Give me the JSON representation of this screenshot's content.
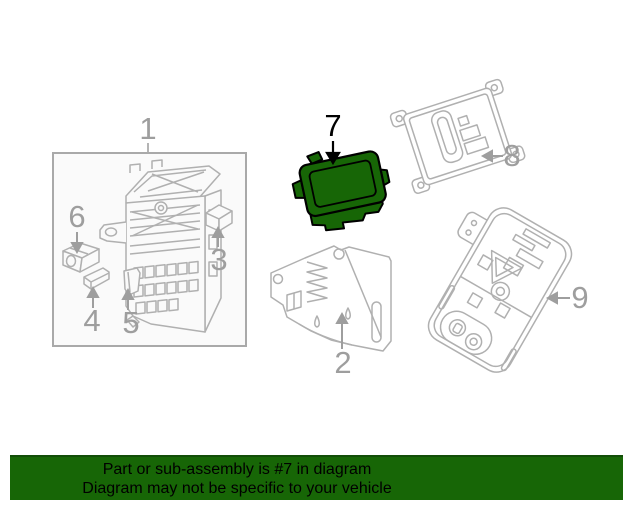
{
  "diagram": {
    "labels": [
      "1",
      "2",
      "3",
      "4",
      "5",
      "6",
      "7",
      "8",
      "9"
    ],
    "highlighted_part_label": "7",
    "colors": {
      "highlight_green": "#176606",
      "highlight_outline": "#000000",
      "line_gray": "#b0b0b0",
      "label_gray": "#9e9e9e",
      "box_border_gray": "#a9a9a9",
      "box_fill": "#fafafa"
    }
  },
  "banner": {
    "line1": "Part or sub-assembly is #7 in diagram",
    "line2": "Diagram may not be specific to your vehicle",
    "background": "#176606",
    "top_border": "#124e08",
    "text_color": "#000000"
  }
}
